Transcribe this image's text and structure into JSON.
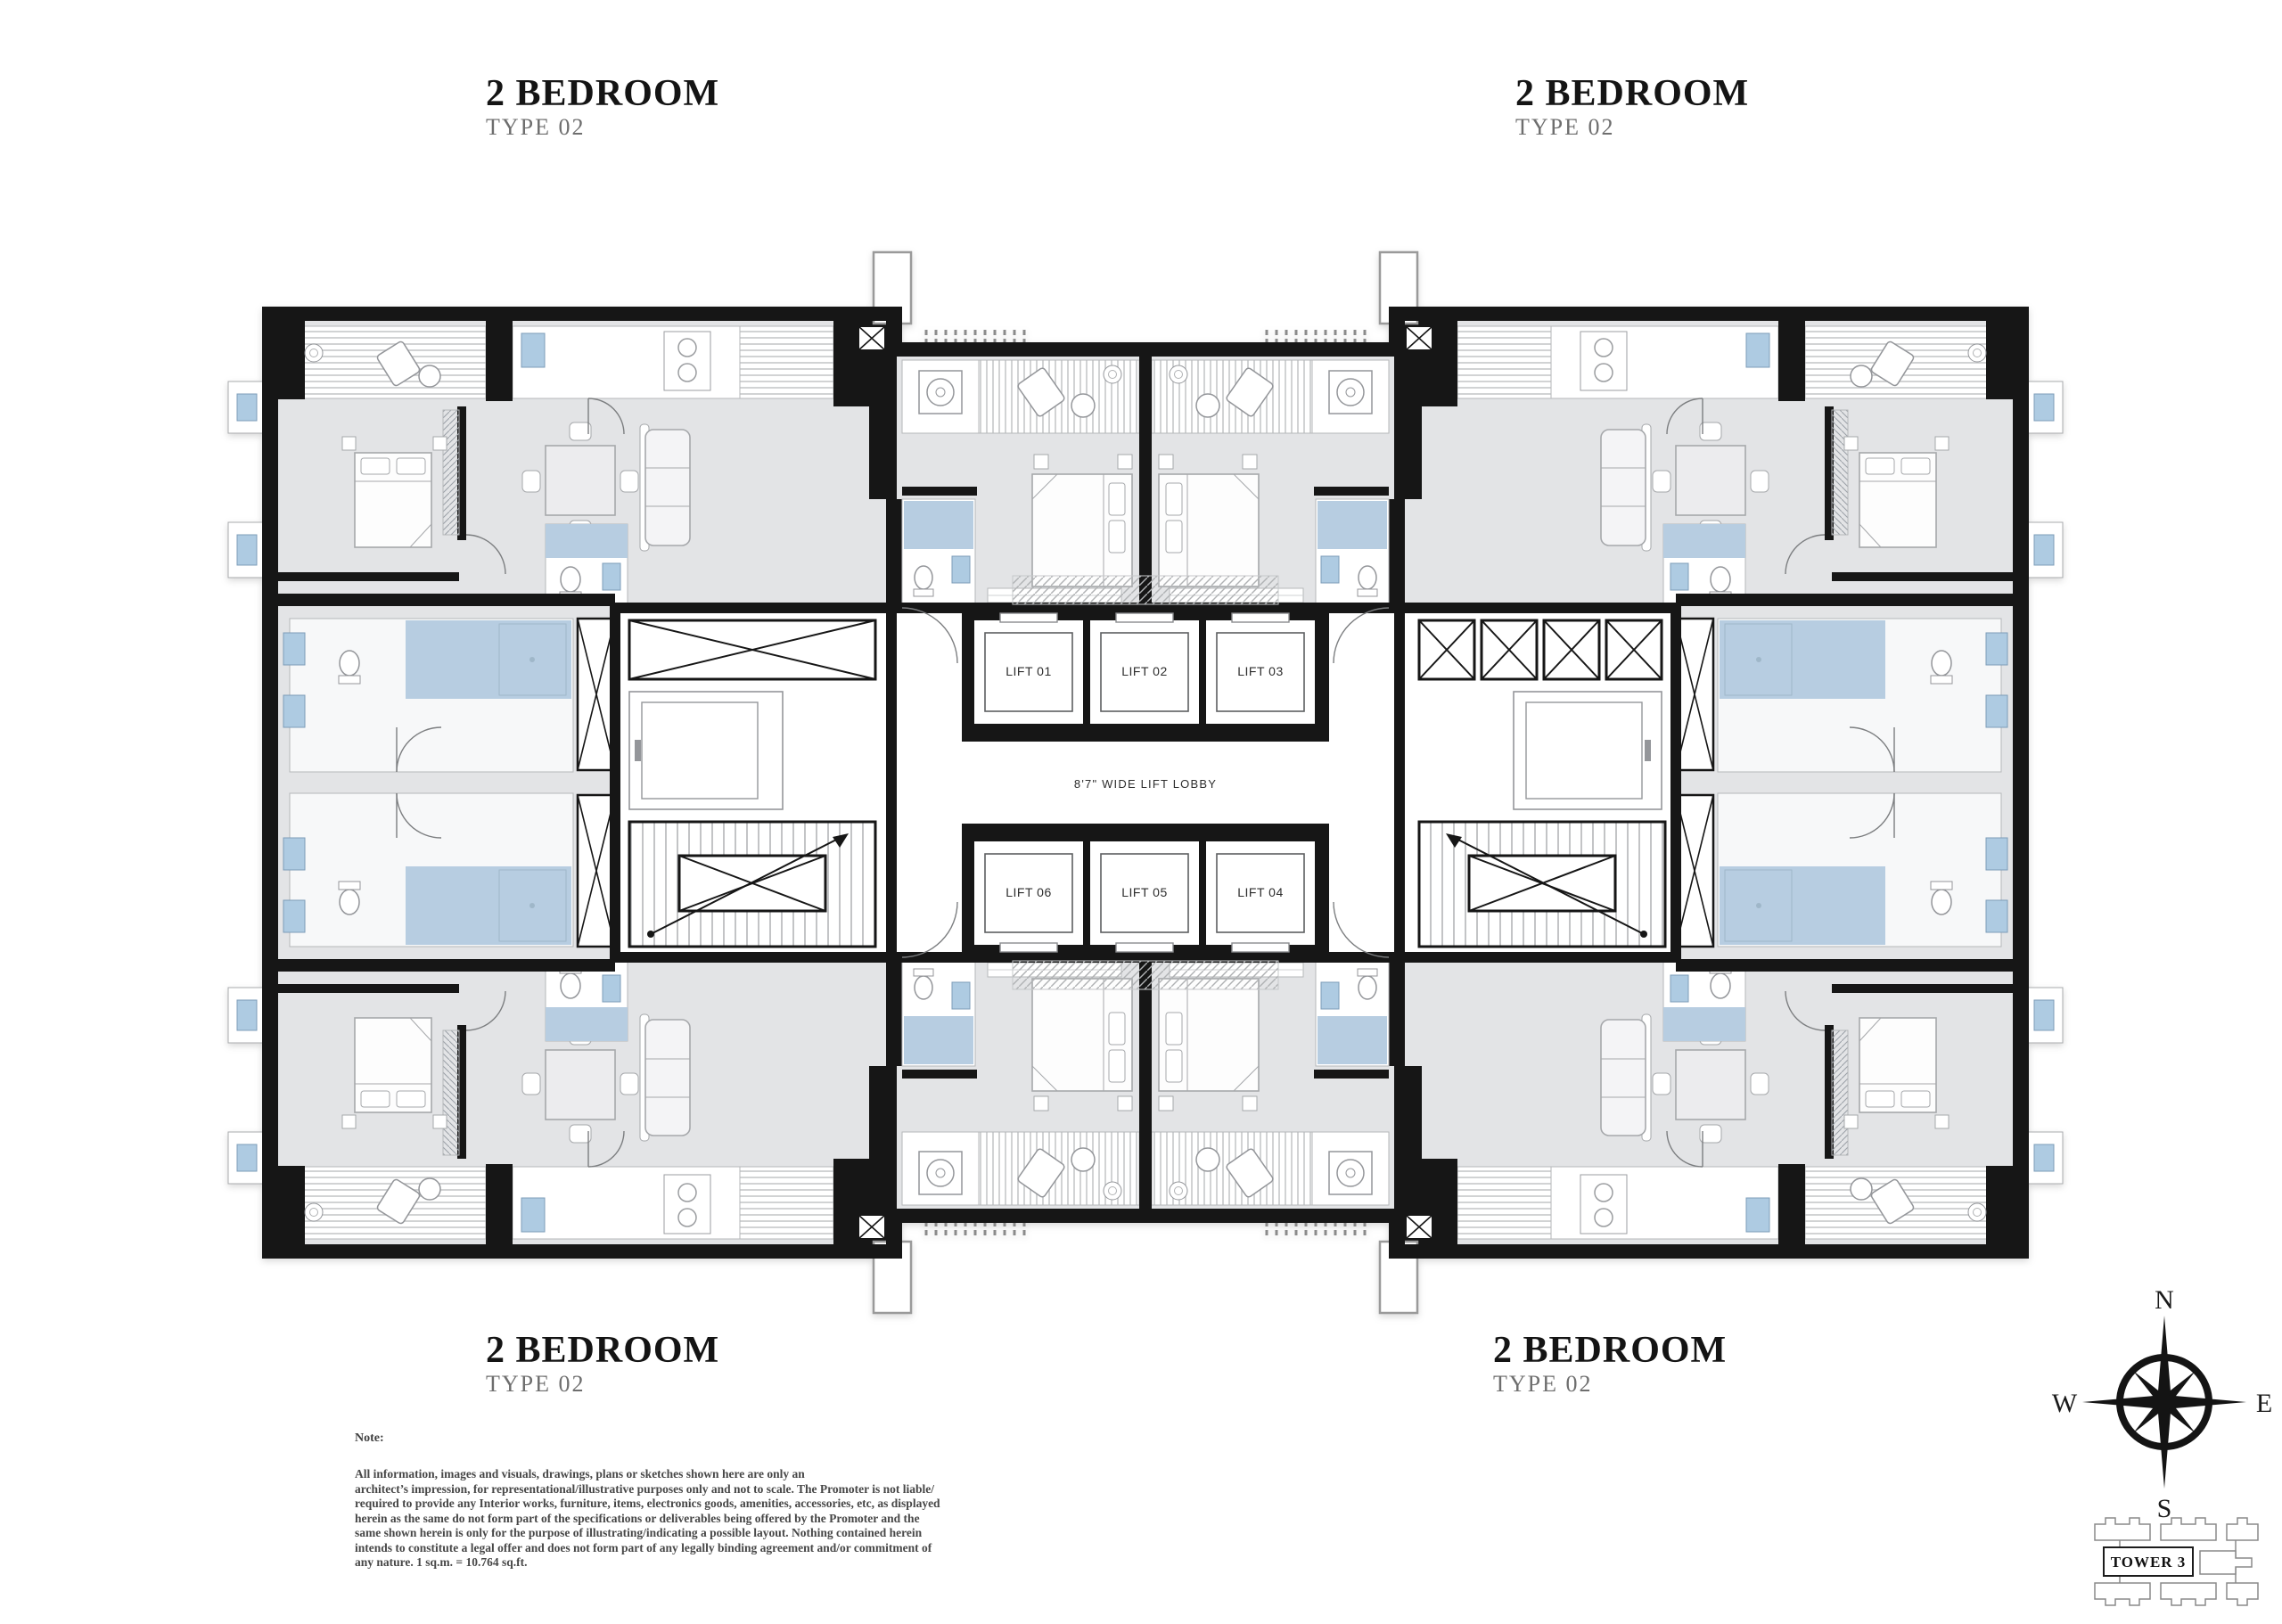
{
  "units": [
    {
      "position": "top-left",
      "title": "2 BEDROOM",
      "subtitle": "TYPE 02"
    },
    {
      "position": "top-right",
      "title": "2 BEDROOM",
      "subtitle": "TYPE 02"
    },
    {
      "position": "bottom-left",
      "title": "2 BEDROOM",
      "subtitle": "TYPE 02"
    },
    {
      "position": "bottom-right",
      "title": "2 BEDROOM",
      "subtitle": "TYPE 02"
    }
  ],
  "core": {
    "lifts": [
      "LIFT 01",
      "LIFT 02",
      "LIFT 03",
      "LIFT 06",
      "LIFT 05",
      "LIFT 04"
    ],
    "lobby_label": "8'7\" WIDE LIFT LOBBY"
  },
  "note": {
    "heading": "Note:",
    "lines": [
      "All information, images and visuals, drawings, plans or sketches shown here are only an",
      "architect’s impression, for representational/illustrative purposes only and not to scale. The Promoter is not liable/",
      "required to provide any Interior works, furniture, items, electronics goods, amenities, accessories, etc, as displayed",
      "herein as the same do not form part of the specifications or deliverables being offered by the Promoter and the",
      "same shown herein is only for the purpose of illustrating/indicating a possible layout. Nothing contained herein",
      "intends to constitute a legal offer and does not form part of any legally binding agreement and/or commitment of",
      "any nature. 1 sq.m. = 10.764 sq.ft."
    ]
  },
  "compass": {
    "n": "N",
    "s": "S",
    "e": "E",
    "w": "W"
  },
  "key_plan": {
    "label": "TOWER 3"
  },
  "colors": {
    "wall": "#161616",
    "room_gray": "#e3e4e6",
    "fixture_blue": "#aecbe2",
    "bath_floor_blue": "#b7cde1",
    "furniture_stroke": "#a6a8ab"
  }
}
